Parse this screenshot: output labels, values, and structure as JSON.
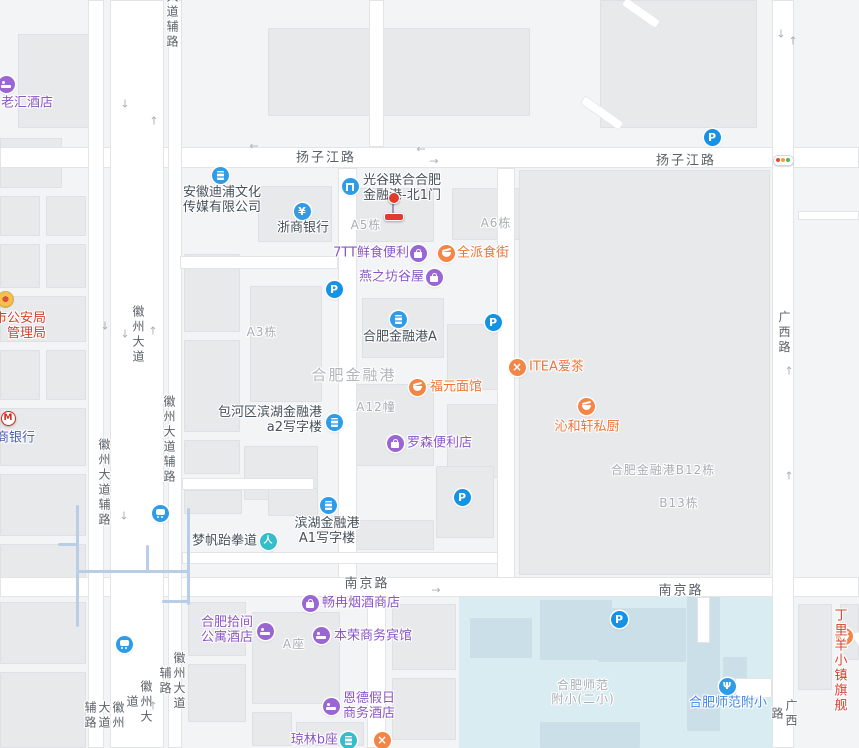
{
  "map": {
    "theme": {
      "purple": "#8a56c6",
      "purpleIcon": "#9a67d2",
      "orange": "#ef7438",
      "orangeIcon": "#f38546",
      "dark": "#46505b",
      "blue": "#4187e2",
      "blueIcon": "#2f9ce8",
      "parkingIcon": "#1492e6",
      "tealIcon": "#35bdc9",
      "red": "#d6412f",
      "bankBlue": "#4c60b0",
      "roadText": "#5b6167",
      "grayLabel": "#a8adb3",
      "grayLabelBig": "#b2b6ba",
      "water": "#d9ecf2",
      "building": "#e8e9eb",
      "road": "#ffffff",
      "trafficRed": "#e8473b",
      "trafficYellow": "#f0a03c",
      "trafficGreen": "#4fba45",
      "markerRed": "#e23a2c"
    },
    "road_labels": [
      {
        "text": "大道辅路",
        "x": 172,
        "y": 20,
        "v": true
      },
      {
        "text": "扬子江路",
        "x": 326,
        "y": 158
      },
      {
        "text": "扬子江路",
        "x": 686,
        "y": 161
      },
      {
        "text": "徽州大道",
        "x": 138,
        "y": 335,
        "v": true
      },
      {
        "text": "徽州大道辅路",
        "x": 169,
        "y": 440,
        "v": true
      },
      {
        "text": "徽州大道辅路",
        "x": 104,
        "y": 483,
        "v": true
      },
      {
        "text": "南京路",
        "x": 367,
        "y": 584
      },
      {
        "text": "南京路",
        "x": 681,
        "y": 591
      },
      {
        "text": "广西路",
        "x": 784,
        "y": 333,
        "v": true
      },
      {
        "text": "广西路",
        "x": 784,
        "y": 714,
        "v": true
      },
      {
        "text": "徽州大道辅路",
        "x": 172,
        "y": 681,
        "v": true
      },
      {
        "text": "徽州大道",
        "x": 139,
        "y": 702,
        "v": true
      },
      {
        "text": "徽州大道辅路",
        "x": 104,
        "y": 716,
        "v": true
      }
    ],
    "building_labels": [
      {
        "text": "A5栋",
        "x": 366,
        "y": 225
      },
      {
        "text": "A6栋",
        "x": 496,
        "y": 223
      },
      {
        "text": "A3栋",
        "x": 262,
        "y": 332
      },
      {
        "text": "合肥金融港",
        "x": 354,
        "y": 375,
        "big": true
      },
      {
        "text": "A12幢",
        "x": 376,
        "y": 407
      },
      {
        "text": "合肥金融港B12栋",
        "x": 663,
        "y": 470
      },
      {
        "text": "B13栋",
        "x": 679,
        "y": 503
      },
      {
        "text": "A座",
        "x": 294,
        "y": 644
      },
      {
        "text": "合肥师范\n附小(二小)",
        "x": 583,
        "y": 692
      }
    ],
    "arrows": [
      {
        "d": "down",
        "x": 125,
        "y": 104
      },
      {
        "d": "up",
        "x": 154,
        "y": 121
      },
      {
        "d": "left",
        "x": 254,
        "y": 146
      },
      {
        "d": "left",
        "x": 421,
        "y": 149
      },
      {
        "d": "right",
        "x": 434,
        "y": 161
      },
      {
        "d": "down",
        "x": 105,
        "y": 326
      },
      {
        "d": "down",
        "x": 125,
        "y": 334
      },
      {
        "d": "up",
        "x": 153,
        "y": 331
      },
      {
        "d": "down",
        "x": 781,
        "y": 34
      },
      {
        "d": "up",
        "x": 793,
        "y": 41
      },
      {
        "d": "up",
        "x": 789,
        "y": 371
      },
      {
        "d": "up",
        "x": 789,
        "y": 476
      },
      {
        "d": "down",
        "x": 124,
        "y": 516
      },
      {
        "d": "up",
        "x": 153,
        "y": 706
      },
      {
        "d": "right",
        "x": 436,
        "y": 590
      }
    ],
    "pois": [
      {
        "name": "poi-laohui-hotel",
        "icon": "bed-icon",
        "icon_color": "purpleIcon",
        "x": 6,
        "y": 84,
        "label": {
          "lines": [
            "老汇酒店"
          ],
          "color": "purple",
          "anchor": "center",
          "x": 27,
          "y": 103
        }
      },
      {
        "name": "poi-anhui-dipu-media",
        "icon": "office-building-icon",
        "icon_color": "blueIcon",
        "x": 220,
        "y": 175,
        "label": {
          "lines": [
            "安徽迪浦文化",
            "传媒有限公司"
          ],
          "color": "dark",
          "anchor": "center",
          "x": 222,
          "y": 200
        }
      },
      {
        "name": "poi-zheshang-bank",
        "icon": "yen-icon",
        "icon_color": "blueIcon",
        "x": 302,
        "y": 211,
        "label": {
          "lines": [
            "浙商银行"
          ],
          "color": "dark",
          "anchor": "center",
          "x": 303,
          "y": 228
        }
      },
      {
        "name": "poi-guanggu-financial-harbor-north-gate-1",
        "icon": "gate-icon",
        "icon_color": "blueIcon",
        "x": 350,
        "y": 186,
        "label": {
          "lines": [
            "光谷联合合肥",
            "金融港-北1门"
          ],
          "color": "dark",
          "anchor": "left",
          "x": 363,
          "y": 188
        }
      },
      {
        "name": "poi-7tt-fresh-convenience",
        "icon": "shop-bag-icon",
        "icon_color": "purpleIcon",
        "x": 418,
        "y": 253,
        "label": {
          "lines": [
            "7TT鲜食便利"
          ],
          "color": "purple",
          "anchor": "right",
          "x": 409,
          "y": 253
        }
      },
      {
        "name": "poi-quanpai-food-street",
        "icon": "food-dish-icon",
        "icon_color": "orangeIcon",
        "x": 446,
        "y": 253,
        "label": {
          "lines": [
            "全派食街"
          ],
          "color": "orange",
          "anchor": "left",
          "x": 457,
          "y": 253
        }
      },
      {
        "name": "poi-yanzhifang-guwu",
        "icon": "shop-bag-icon",
        "icon_color": "purpleIcon",
        "x": 434,
        "y": 277,
        "label": {
          "lines": [
            "燕之坊谷屋"
          ],
          "color": "purple",
          "anchor": "right",
          "x": 424,
          "y": 277
        }
      },
      {
        "name": "poi-hefei-financial-harbor-a",
        "icon": "office-building-icon",
        "icon_color": "blueIcon",
        "x": 398,
        "y": 319,
        "label": {
          "lines": [
            "合肥金融港A"
          ],
          "color": "dark",
          "anchor": "center",
          "x": 400,
          "y": 337
        }
      },
      {
        "name": "poi-fuyuan-noodle-house",
        "icon": "food-bowl-icon",
        "icon_color": "orangeIcon",
        "x": 417,
        "y": 387,
        "label": {
          "lines": [
            "福元面馆"
          ],
          "color": "orange",
          "anchor": "left",
          "x": 430,
          "y": 387
        }
      },
      {
        "name": "poi-itea-tea",
        "icon": "fork-cross-icon",
        "icon_color": "orangeIcon",
        "x": 517,
        "y": 367,
        "label": {
          "lines": [
            "ITEA爱茶"
          ],
          "color": "orange",
          "anchor": "left",
          "x": 529,
          "y": 367
        }
      },
      {
        "name": "poi-qinhexuan-private-kitchen",
        "icon": "food-bowl-icon",
        "icon_color": "orangeIcon",
        "x": 586,
        "y": 406,
        "label": {
          "lines": [
            "沁和轩私厨"
          ],
          "color": "orange",
          "anchor": "center",
          "x": 587,
          "y": 427
        }
      },
      {
        "name": "poi-baohe-binhu-a2-office",
        "icon": "office-building-icon",
        "icon_color": "blueIcon",
        "x": 334,
        "y": 422,
        "label": {
          "lines": [
            "包河区滨湖金融港",
            "a2写字楼"
          ],
          "color": "dark",
          "anchor": "right",
          "x": 322,
          "y": 420
        }
      },
      {
        "name": "poi-lawson-convenience",
        "icon": "shop-bag-icon",
        "icon_color": "purpleIcon",
        "x": 395,
        "y": 443,
        "label": {
          "lines": [
            "罗森便利店"
          ],
          "color": "purple",
          "anchor": "left",
          "x": 407,
          "y": 443
        }
      },
      {
        "name": "poi-binhu-a1-office",
        "icon": "office-building-icon",
        "icon_color": "blueIcon",
        "x": 328,
        "y": 505,
        "label": {
          "lines": [
            "滨湖金融港",
            "A1写字楼"
          ],
          "color": "dark",
          "anchor": "center",
          "x": 327,
          "y": 531
        }
      },
      {
        "name": "poi-mengfan-taekwondo",
        "icon": "person-icon",
        "icon_color": "tealIcon",
        "x": 268,
        "y": 541,
        "label": {
          "lines": [
            "梦帆跆拳道"
          ],
          "color": "dark",
          "anchor": "right",
          "x": 257,
          "y": 541
        }
      },
      {
        "name": "poi-changran-tobacco-shop",
        "icon": "shop-bag-icon",
        "icon_color": "purpleIcon",
        "x": 310,
        "y": 603,
        "label": {
          "lines": [
            "畅冉烟酒商店"
          ],
          "color": "purple",
          "anchor": "left",
          "x": 322,
          "y": 603
        }
      },
      {
        "name": "poi-hefei-shijian-apartment-hotel",
        "icon": "bed-icon",
        "icon_color": "purpleIcon",
        "x": 265,
        "y": 631,
        "label": {
          "lines": [
            "合肥拾间",
            "公寓酒店"
          ],
          "color": "purple",
          "anchor": "right",
          "x": 253,
          "y": 630
        }
      },
      {
        "name": "poi-benrong-business-hotel",
        "icon": "bed-icon",
        "icon_color": "purpleIcon",
        "x": 321,
        "y": 635,
        "label": {
          "lines": [
            "本荣商务宾馆"
          ],
          "color": "purple",
          "anchor": "left",
          "x": 334,
          "y": 636
        }
      },
      {
        "name": "poi-ende-holiday-hotel",
        "icon": "bed-icon",
        "icon_color": "purpleIcon",
        "x": 331,
        "y": 706,
        "label": {
          "lines": [
            "恩德假日",
            "商务酒店"
          ],
          "color": "purple",
          "anchor": "left",
          "x": 343,
          "y": 706
        }
      },
      {
        "name": "poi-qionglin-block-b",
        "icon": "building-icon",
        "icon_color": "tealIcon",
        "x": 348,
        "y": 740,
        "label": {
          "lines": [
            "琼林b座"
          ],
          "color": "purple",
          "anchor": "right",
          "x": 338,
          "y": 740
        }
      },
      {
        "name": "poi-food-marker",
        "icon": "fork-cross-icon",
        "icon_color": "orangeIcon",
        "x": 382,
        "y": 740
      },
      {
        "name": "poi-hefei-normal-primary-school",
        "icon": "school-icon",
        "icon_color": "blueIcon",
        "x": 727,
        "y": 686,
        "label": {
          "lines": [
            "合肥师范附小"
          ],
          "color": "blue",
          "anchor": "center",
          "x": 728,
          "y": 703
        }
      },
      {
        "name": "poi-dingliyang-flagship",
        "icon": "food-bowl-icon",
        "icon_color": "orangeIcon",
        "x": 844,
        "y": 636,
        "label": {
          "lines": [
            "丁里羊",
            "小镇旗舰"
          ],
          "color": "red",
          "anchor": "center",
          "x": 841,
          "y": 661
        }
      },
      {
        "name": "poi-public-security-bureau",
        "icon": "police-badge-icon",
        "icon_color": "police",
        "x": 5,
        "y": 299,
        "label": {
          "lines": [
            "市公安局",
            "管理局"
          ],
          "color": "red",
          "anchor": "right",
          "x": 46,
          "y": 326
        }
      },
      {
        "name": "poi-cmb-bank",
        "icon": "cmb-logo-icon",
        "icon_color": "cmb",
        "x": 8,
        "y": 418,
        "label": {
          "lines": [
            "招商银行"
          ],
          "color": "bankBlue",
          "anchor": "right",
          "x": 35,
          "y": 438
        }
      },
      {
        "name": "poi-parking",
        "icon": "parking-icon",
        "icon_color": "parkingIcon",
        "x": 712,
        "y": 137
      },
      {
        "name": "poi-parking",
        "icon": "parking-icon",
        "icon_color": "parkingIcon",
        "x": 334,
        "y": 289
      },
      {
        "name": "poi-parking",
        "icon": "parking-icon",
        "icon_color": "parkingIcon",
        "x": 493,
        "y": 322
      },
      {
        "name": "poi-parking",
        "icon": "parking-icon",
        "icon_color": "parkingIcon",
        "x": 462,
        "y": 497
      },
      {
        "name": "poi-parking",
        "icon": "parking-icon",
        "icon_color": "parkingIcon",
        "x": 619,
        "y": 619
      },
      {
        "name": "poi-metro-station",
        "icon": "metro-icon",
        "icon_color": "blueIcon",
        "x": 160,
        "y": 513
      },
      {
        "name": "poi-metro-station",
        "icon": "metro-icon",
        "icon_color": "blueIcon",
        "x": 124,
        "y": 644
      }
    ],
    "traffic_light": {
      "x": 783,
      "y": 160
    },
    "marker": {
      "x": 393,
      "y": 197
    }
  }
}
